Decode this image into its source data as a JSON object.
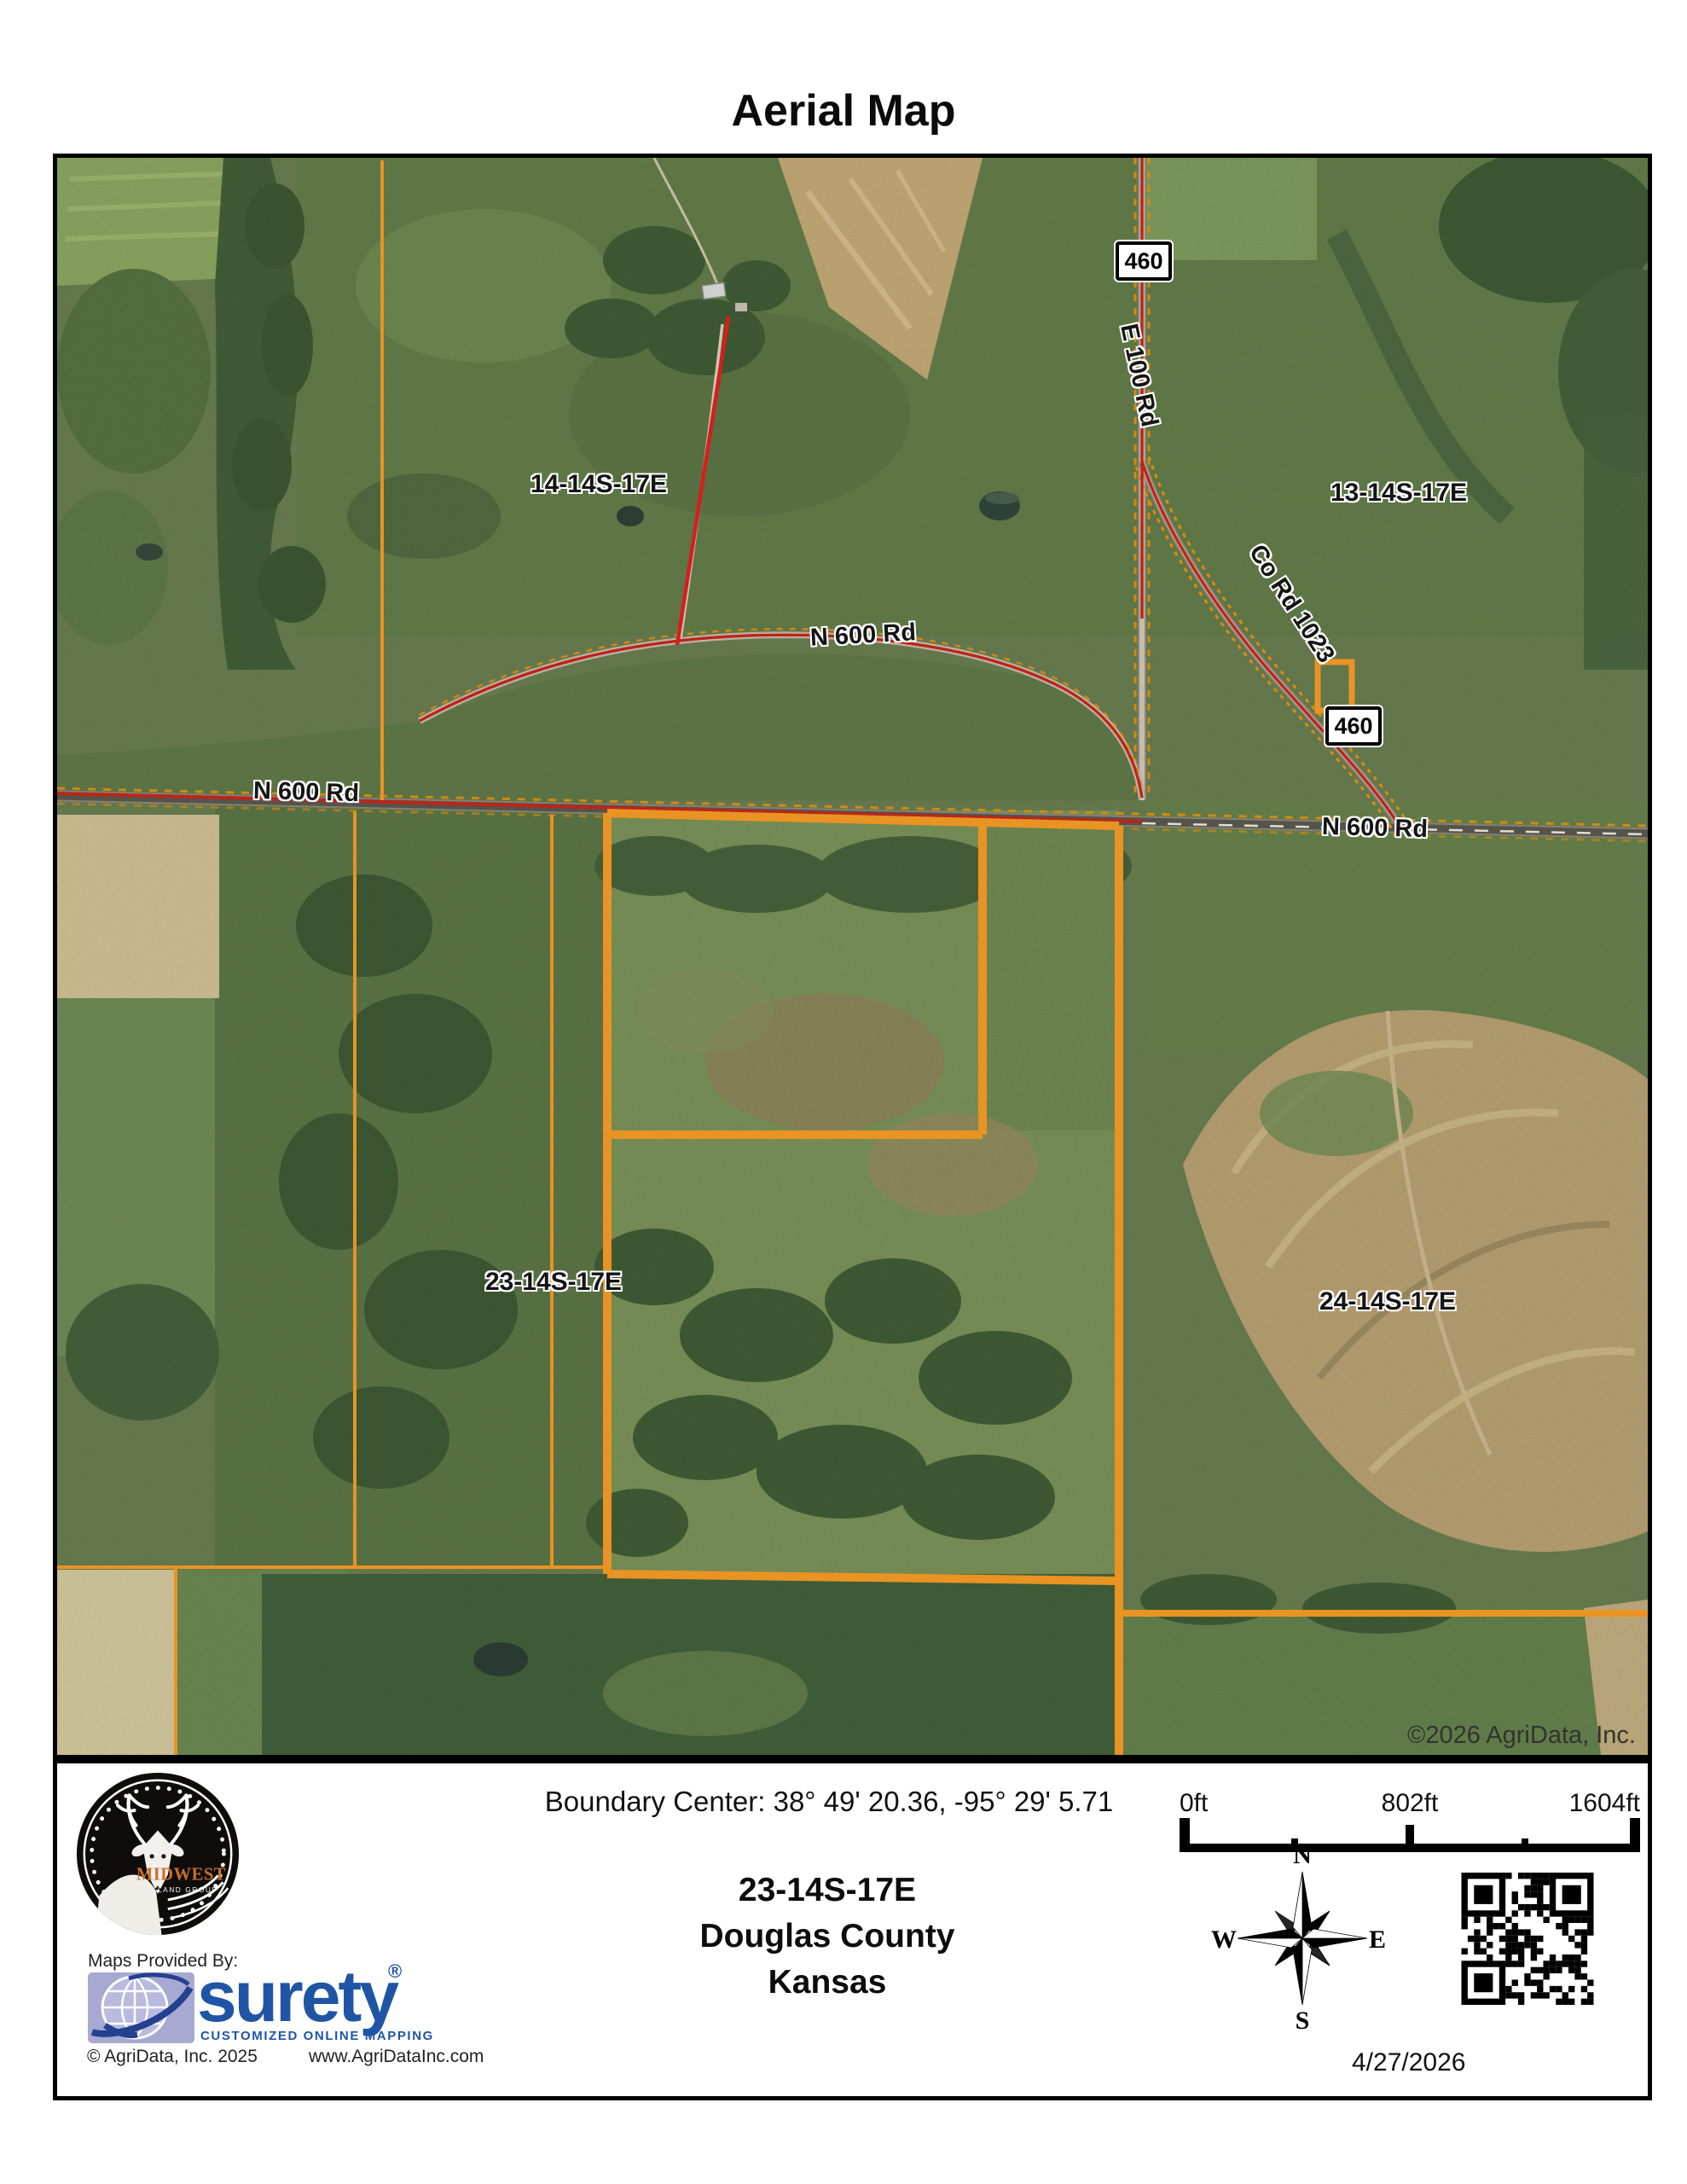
{
  "title": "Aerial Map",
  "map": {
    "copyright": "©2026 AgriData, Inc.",
    "sections": [
      "14-14S-17E",
      "13-14S-17E",
      "23-14S-17E",
      "24-14S-17E"
    ],
    "roads": [
      "N 600 Rd",
      "N 600 Rd",
      "N 600 Rd",
      "E 100 Rd",
      "Co Rd 1023"
    ],
    "shields": [
      "460",
      "460"
    ]
  },
  "footer": {
    "boundary_center": "Boundary Center: 38° 49' 20.36,  -95° 29' 5.71",
    "scale_labels": [
      "0ft",
      "802ft",
      "1604ft"
    ],
    "location": {
      "section": "23-14S-17E",
      "county": "Douglas County",
      "state": "Kansas"
    },
    "compass": {
      "n": "N",
      "e": "E",
      "s": "S",
      "w": "W"
    },
    "provided_by": "Maps Provided By:",
    "surety": {
      "name": "surety",
      "registered": "®",
      "tagline": "CUSTOMIZED ONLINE MAPPING"
    },
    "agridata_copyright": "© AgriData, Inc. 2025",
    "website": "www.AgriDataInc.com",
    "logo": {
      "name": "MIDWEST",
      "subname": "LAND GROUP"
    },
    "date": "4/27/2026"
  },
  "colors": {
    "boundary_orange": "#F59B25",
    "route_red": "#C4281C",
    "annotation_red": "#E31F1F",
    "surety_blue": "#1F55A4",
    "midwest_orange": "#C96F2B"
  }
}
